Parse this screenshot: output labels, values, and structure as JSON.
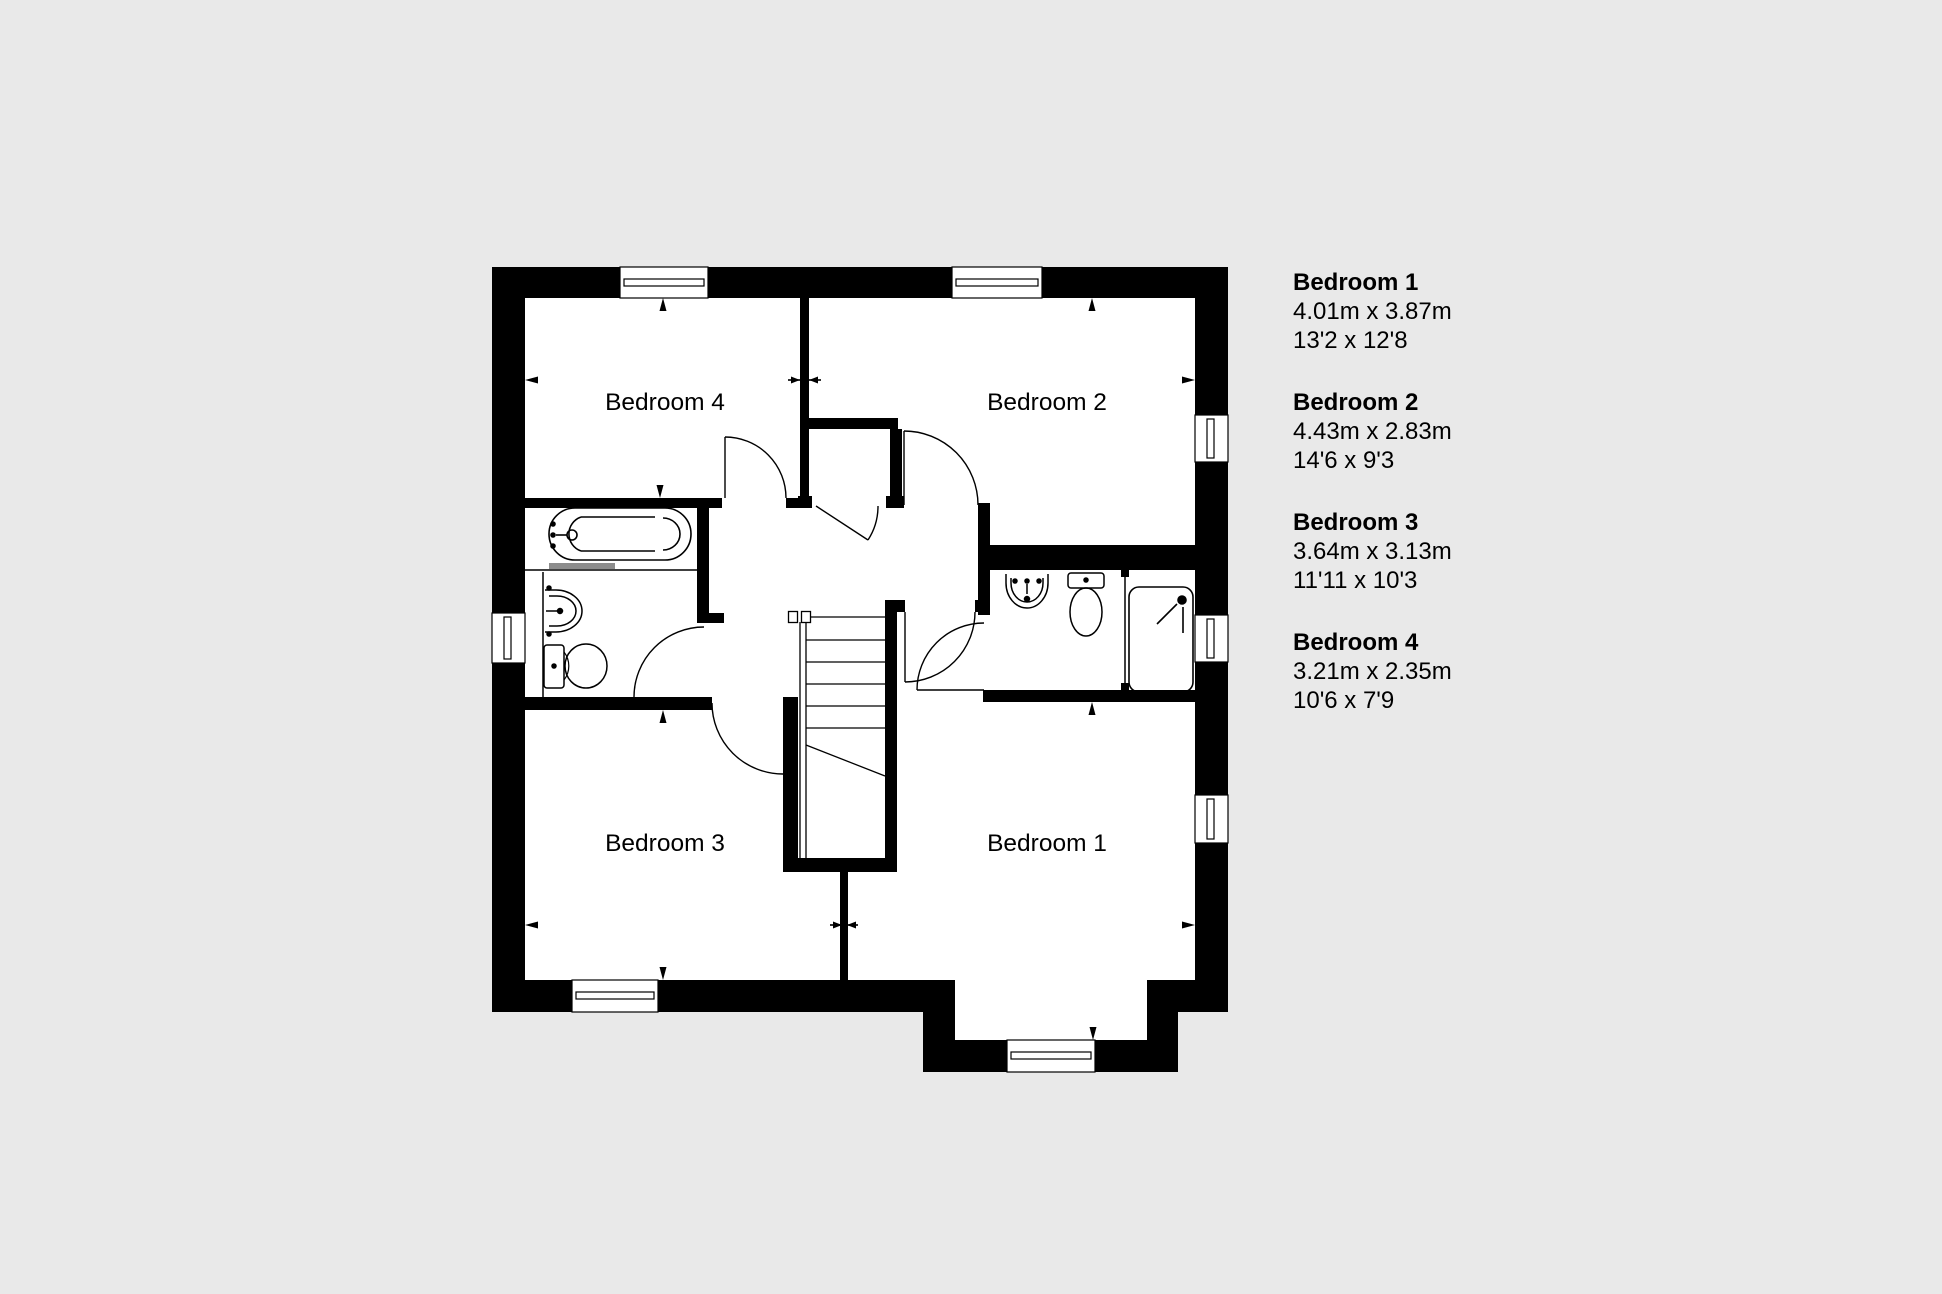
{
  "plan": {
    "labels": {
      "bedroom1": "Bedroom 1",
      "bedroom2": "Bedroom 2",
      "bedroom3": "Bedroom 3",
      "bedroom4": "Bedroom 4"
    },
    "fixtures": [
      "bathtub",
      "basin",
      "toilet",
      "shower",
      "stairs",
      "windows",
      "door-arcs"
    ]
  },
  "legend": {
    "entries": [
      {
        "name": "Bedroom 1",
        "metric": "4.01m x 3.87m",
        "imperial": "13'2 x 12'8"
      },
      {
        "name": "Bedroom 2",
        "metric": "4.43m x 2.83m",
        "imperial": "14'6 x 9'3"
      },
      {
        "name": "Bedroom 3",
        "metric": "3.64m x 3.13m",
        "imperial": "11'11 x 10'3"
      },
      {
        "name": "Bedroom 4",
        "metric": "3.21m x 2.35m",
        "imperial": "10'6 x 7'9"
      }
    ]
  },
  "colors": {
    "background": "#e9e9e9",
    "walls": "#000000",
    "floor": "#ffffff",
    "glass_screen": "#8c8c8c"
  }
}
